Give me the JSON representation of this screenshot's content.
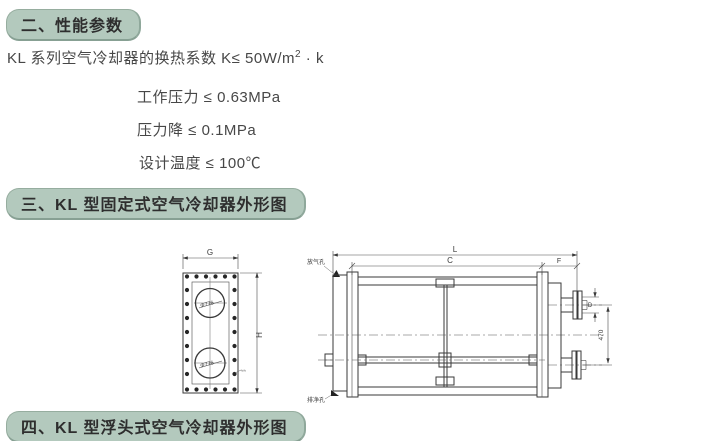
{
  "sections": {
    "s2": {
      "title": "二、性能参数"
    },
    "s3": {
      "title": "三、KL 型固定式空气冷却器外形图"
    },
    "s4": {
      "title": "四、KL 型浮头式空气冷却器外形图"
    }
  },
  "params": {
    "heat_transfer_prefix": "KL 系列空气冷却器的换热系数 K≤ 50W/m",
    "heat_transfer_sup": "2",
    "heat_transfer_suffix": " · k",
    "items": [
      "工作压力 ≤ 0.63MPa",
      "压力降 ≤ 0.1MPa",
      "设计温度 ≤ 100℃"
    ]
  },
  "drawing": {
    "front_view": {
      "dim_width": "G",
      "dim_height": "H",
      "circle_label_top": "Φ776",
      "circle_label_bottom": "Φ776",
      "note": "≈≈"
    },
    "side_view": {
      "dim_length": "L",
      "dim_inner": "C",
      "dim_right": "F",
      "dim_nozzle": "D",
      "dim_nozzle_span": "470",
      "label_vent": "放气孔",
      "label_drain": "排净孔"
    }
  }
}
